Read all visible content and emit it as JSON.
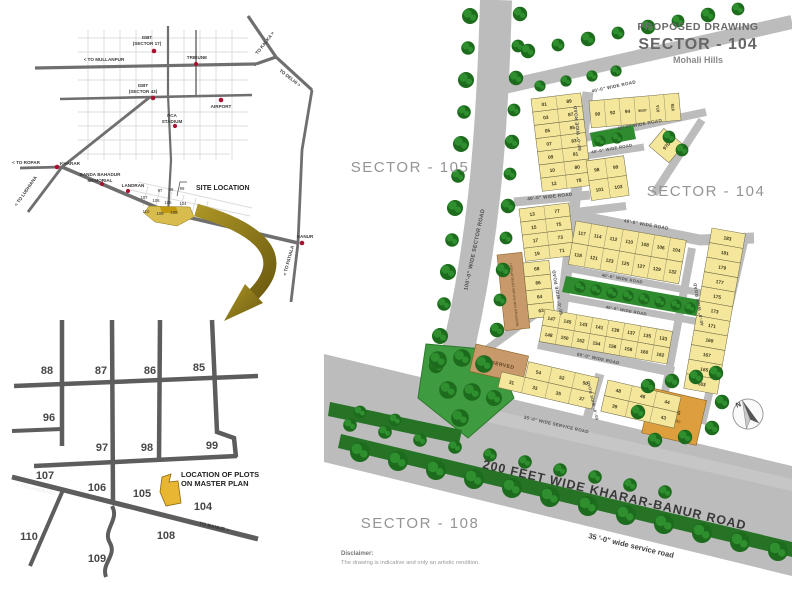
{
  "header": {
    "proposed_drawing": "PROPOSED DRAWING",
    "sector_title": "SECTOR - 104",
    "subtitle": "Mohali Hills"
  },
  "sector_labels": {
    "s105": "SECTOR - 105",
    "s104": "SECTOR - 104",
    "s108": "SECTOR - 108"
  },
  "disclaimer": {
    "label": "Disclaimer:",
    "text": "The drawing is indicative and only an artistic rendition."
  },
  "road_labels": {
    "w40": "40'-0\" WIDE ROAD",
    "w60": "60'-0\" WIDE ROAD",
    "w100": "100'-0\" WIDE SECTOR ROAD",
    "service_upper": "35'-0\" WIDE SERVICE ROAD",
    "service_lower": "35 '-0\" wide service road",
    "kharar_banur": "200 FEET WIDE KHARAR-BANUR ROAD"
  },
  "top_map": {
    "labels": {
      "isbt17_1": "ISBT",
      "isbt17_2": "(SECTOR 17)",
      "isbt43_1": "ISBT",
      "isbt43_2": "(SECTOR 43)",
      "tribune": "TRIBUNE",
      "airport": "AIRPORT",
      "pca_1": "PCA",
      "pca_2": "STADIUM",
      "mullanpur": "< TO MULLANPUR",
      "kalka": "TO KALKA >",
      "delhi": "TO DELHI >",
      "ropar": "< TO ROPAR",
      "ludhiana": "< TO LUDHIANA",
      "patiala": "< TO PATIALA",
      "kharar": "KHARAR",
      "memorial_1": "BANDA BAHADUR",
      "memorial_2": "MEMORIAL",
      "landran": "LANDRAN",
      "banur": "BANUR",
      "site_location": "SITE LOCATION"
    },
    "sectors": [
      "97",
      "98",
      "99",
      "107",
      "106",
      "105",
      "104",
      "110",
      "109",
      "108"
    ]
  },
  "bottom_map": {
    "sectors": {
      "s88": "88",
      "s87": "87",
      "s86": "86",
      "s85": "85",
      "s96": "96",
      "s97": "97",
      "s98": "98",
      "s99": "99",
      "s107": "107",
      "s106": "106",
      "s105": "105",
      "s110": "110",
      "s109": "109",
      "s108": "108",
      "s104": "104"
    },
    "note_1": "LOCATION OF PLOTS",
    "note_2": "ON MASTER PLAN",
    "to_banur": "TO BANUR >",
    "to_landran": "< TO LANDRAN"
  },
  "site_plan": {
    "reserved_future": "RESERVED FOR FUTURE DEVELOPMENT",
    "reserved": "RESERVED",
    "ess_line1": "ESS",
    "ess_line2": "0.77 Ac",
    "plot_97d": "97D",
    "north": "N",
    "blocks": {
      "a1": [
        [
          "01",
          "89"
        ],
        [
          "03",
          "87"
        ],
        [
          "05",
          "85"
        ],
        [
          "07",
          "83"
        ],
        [
          "09",
          "81"
        ],
        [
          "10",
          "80"
        ],
        [
          "12",
          "78"
        ]
      ],
      "a2": [
        [
          "13",
          "77"
        ],
        [
          "15",
          "75"
        ],
        [
          "17",
          "73"
        ],
        [
          "19",
          "71"
        ]
      ],
      "a3": [
        [
          "68"
        ],
        [
          "66"
        ],
        [
          "64"
        ],
        [
          "63"
        ]
      ],
      "wedge": [
        [
          "90",
          "92",
          "94",
          "96/97",
          "97A",
          "97B"
        ]
      ],
      "nblock": [
        [
          "98",
          "99"
        ],
        [
          "101",
          "103"
        ]
      ],
      "mid": [
        [
          "117",
          "114",
          "112",
          "110",
          "108",
          "106",
          "104"
        ],
        [
          "118",
          "121",
          "123",
          "125",
          "127",
          "129",
          "132"
        ]
      ],
      "rcol": [
        [
          "183"
        ],
        [
          "181"
        ],
        [
          "179"
        ],
        [
          "177"
        ],
        [
          "175"
        ],
        [
          "173"
        ],
        [
          "171"
        ],
        [
          "169"
        ],
        [
          "167"
        ],
        [
          "165"
        ],
        [
          "163"
        ]
      ],
      "b143": [
        [
          "147",
          "145",
          "143",
          "141",
          "139",
          "137",
          "135",
          "133"
        ],
        [
          "148",
          "150",
          "152",
          "154",
          "156",
          "158",
          "160",
          "162"
        ]
      ],
      "bbl": [
        [
          "54",
          "52",
          "50"
        ],
        [
          "31",
          "33",
          "35",
          "37"
        ]
      ],
      "bbr": [
        [
          "48",
          "46",
          "44"
        ],
        [
          "39",
          "41",
          "43"
        ]
      ]
    }
  },
  "colors": {
    "plot_yellow": "#f4e69a",
    "road_gray": "#bcbcbc",
    "tree_green": "#1d6b1d",
    "highlight_gold": "#e2b33c",
    "reserved_tan": "#c89a6b",
    "ess_orange": "#dd9f3e",
    "marker_red": "#aa1130"
  }
}
